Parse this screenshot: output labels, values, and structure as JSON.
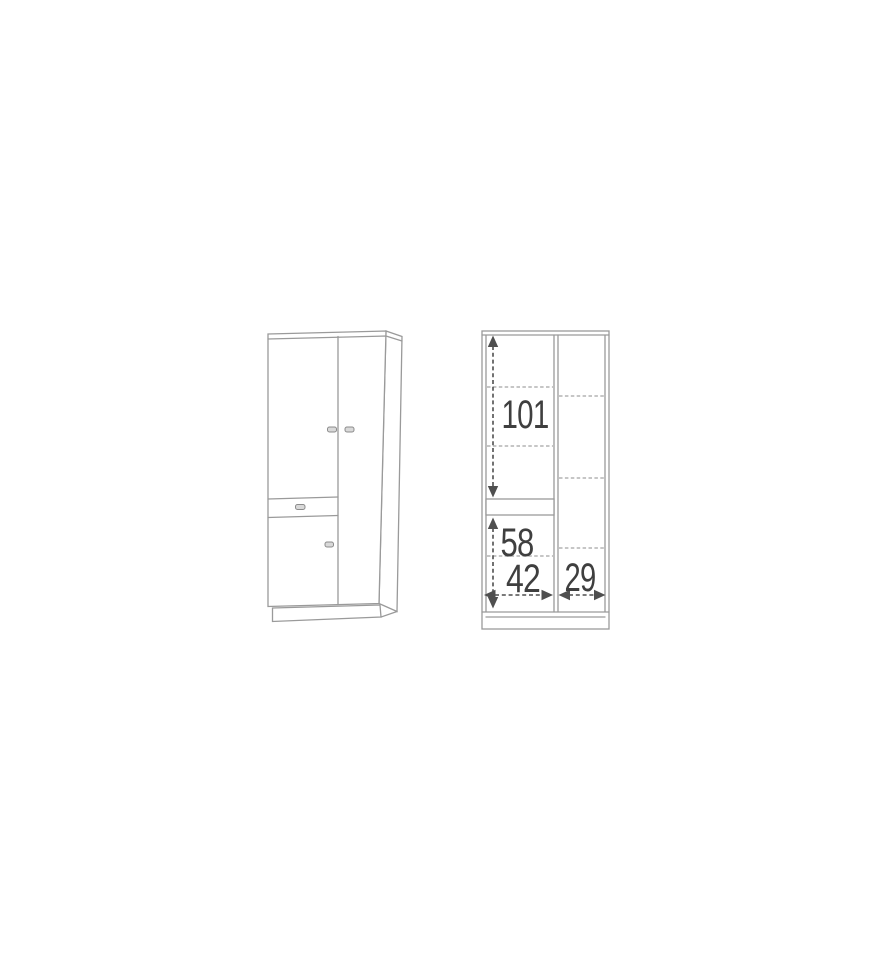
{
  "diagram": {
    "kind": "wardrobe-dimension-drawing",
    "colors": {
      "background": "#ffffff",
      "cabinet_outline": "#9a9a9a",
      "shelf_dashed_line": "#b3b3b3",
      "measurement_line": "#4f4f4f",
      "dimension_text": "#3f3f3f"
    },
    "dimensions": {
      "interior_height_upper": "101",
      "interior_height_lower": "58",
      "compartment_width_left": "42",
      "compartment_width_right": "29"
    }
  }
}
